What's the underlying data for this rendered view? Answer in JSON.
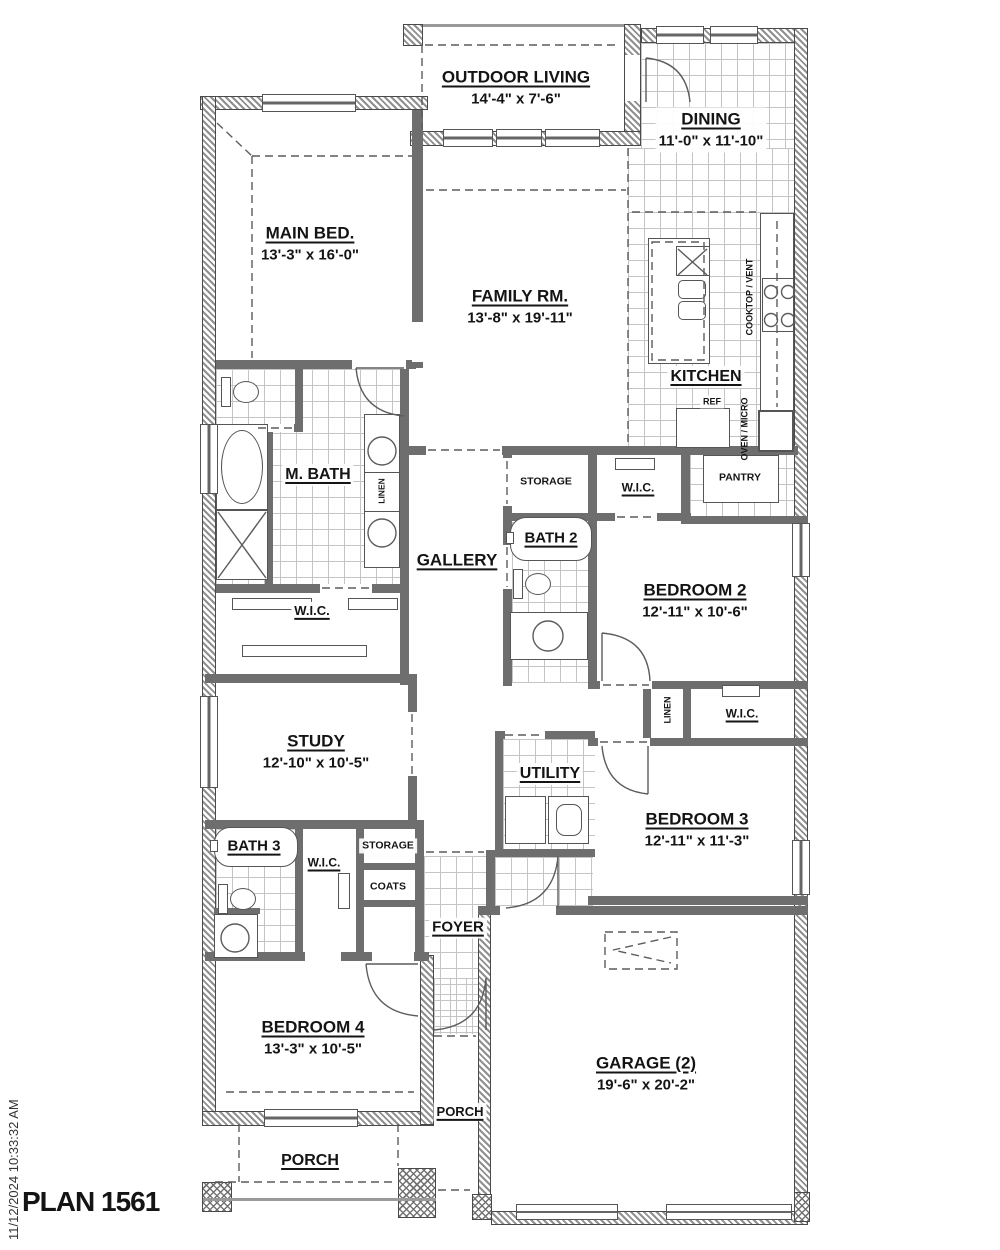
{
  "plan": {
    "title": "PLAN 1561",
    "timestamp": "11/12/2024 10:33:32 AM"
  },
  "rooms": {
    "outdoor_living": {
      "name": "OUTDOOR LIVING",
      "dims": "14'-4\" x 7'-6\""
    },
    "dining": {
      "name": "DINING",
      "dims": "11'-0\" x 11'-10\""
    },
    "main_bed": {
      "name": "MAIN BED.",
      "dims": "13'-3\" x 16'-0\""
    },
    "family_rm": {
      "name": "FAMILY RM.",
      "dims": "13'-8\" x 19'-11\""
    },
    "kitchen": {
      "name": "KITCHEN"
    },
    "pantry": {
      "name": "PANTRY"
    },
    "m_bath": {
      "name": "M. BATH"
    },
    "linen_mbath": {
      "name": "LINEN"
    },
    "gallery": {
      "name": "GALLERY"
    },
    "storage_hall": {
      "name": "STORAGE"
    },
    "wic_bed2": {
      "name": "W.I.C."
    },
    "bath2": {
      "name": "BATH 2"
    },
    "bedroom2": {
      "name": "BEDROOM 2",
      "dims": "12'-11\" x 10'-6\""
    },
    "wic_main": {
      "name": "W.I.C."
    },
    "study": {
      "name": "STUDY",
      "dims": "12'-10\" x 10'-5\""
    },
    "utility": {
      "name": "UTILITY"
    },
    "linen_hall": {
      "name": "LINEN"
    },
    "wic_bed3": {
      "name": "W.I.C."
    },
    "bedroom3": {
      "name": "BEDROOM 3",
      "dims": "12'-11\" x 11'-3\""
    },
    "bath3": {
      "name": "BATH 3"
    },
    "wic_bed4": {
      "name": "W.I.C."
    },
    "storage_entry": {
      "name": "STORAGE"
    },
    "coats": {
      "name": "COATS"
    },
    "foyer": {
      "name": "FOYER"
    },
    "bedroom4": {
      "name": "BEDROOM 4",
      "dims": "13'-3\" x 10'-5\""
    },
    "garage": {
      "name": "GARAGE (2)",
      "dims": "19'-6\" x 20'-2\""
    },
    "porch_rear": {
      "name": "PORCH"
    },
    "porch_front": {
      "name": "PORCH"
    }
  },
  "appliances": {
    "ref": "REF",
    "cooktop_vent": "COOKTOP / VENT",
    "oven_micro": "OVEN / MICRO"
  }
}
